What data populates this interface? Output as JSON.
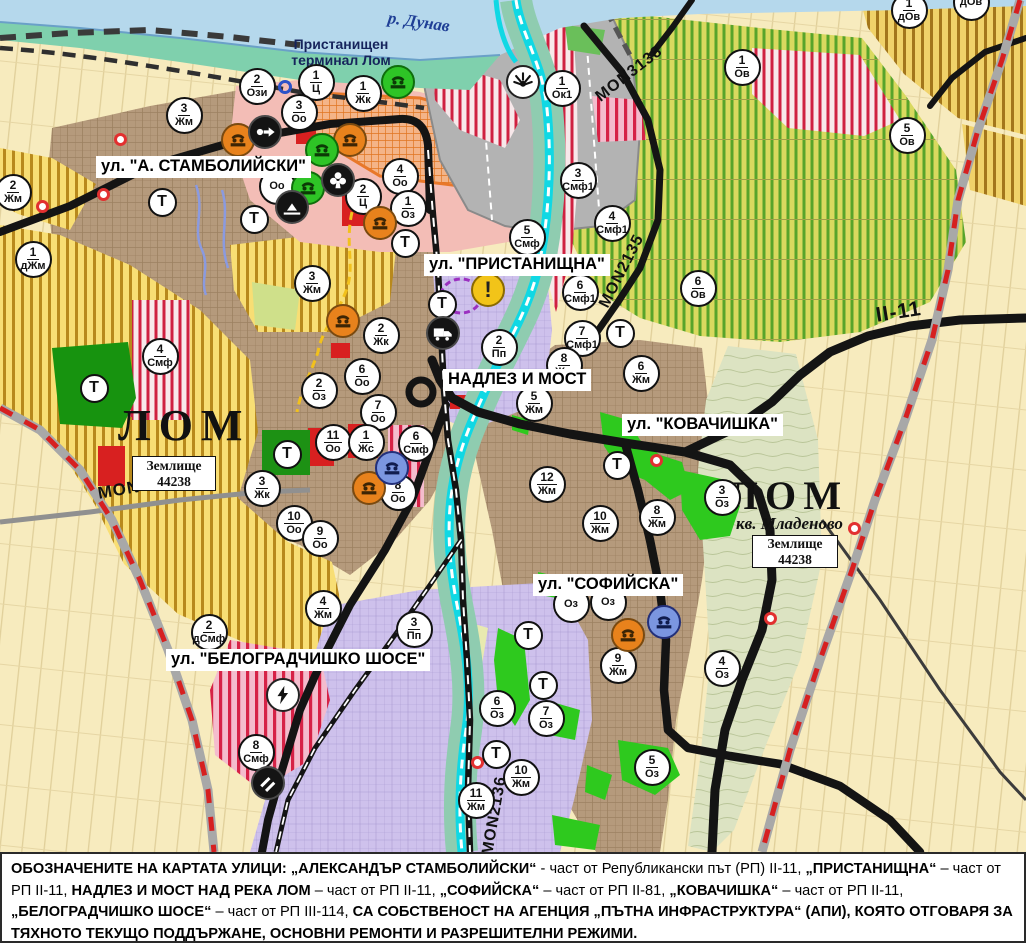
{
  "canvas": {
    "width": 1026,
    "height": 943
  },
  "colors": {
    "danube": "#b5d8ec",
    "coast": "#7fd0ad",
    "river_lom": "#10d8e4",
    "road_black": "#141414",
    "boundary_red": "#d62020",
    "boundary_gray": "#a8a8a8",
    "city_brown": "#b59a7c",
    "residential_yellow": "#f8de74",
    "vineyard_green": "#57a42b",
    "mixed_red_stripe": "#cf2040",
    "industry_purple": "#cec1ec",
    "park_green": "#2ec91e",
    "port_gray": "#b3b3b3",
    "center_pink": "#f3bdb6",
    "warning_yellow": "#f2c419"
  },
  "street_labels": [
    {
      "id": "stamboliyski",
      "text": "ул. \"А. СТАМБОЛИЙСКИ\"",
      "x": 96,
      "y": 156
    },
    {
      "id": "pristanishtna",
      "text": "ул. \"ПРИСТАНИЩНА\"",
      "x": 424,
      "y": 254
    },
    {
      "id": "nadlez",
      "text": "НАДЛЕЗ И МОСТ",
      "x": 443,
      "y": 369
    },
    {
      "id": "kovachishka",
      "text": "ул. \"КОВАЧИШКА\"",
      "x": 622,
      "y": 414
    },
    {
      "id": "sofiyska",
      "text": "ул. \"СОФИЙСКА\"",
      "x": 533,
      "y": 574
    },
    {
      "id": "belogradchishko",
      "text": "ул. \"БЕЛОГРАДЧИШКО ШОСЕ\"",
      "x": 166,
      "y": 649
    }
  ],
  "place_labels": [
    {
      "text": "р. Дунав",
      "cls": "river",
      "x": 388,
      "y": 8,
      "rot": 8,
      "size": 17
    },
    {
      "text": "Пристанищен\nтерминал Лом",
      "cls": "port",
      "x": 266,
      "y": 36,
      "rot": 0,
      "size": 14
    },
    {
      "text": "ЛОМ",
      "cls": "city",
      "x": 118,
      "y": 404,
      "rot": 0,
      "size": 44
    },
    {
      "text": "ЛОМ",
      "cls": "city",
      "x": 728,
      "y": 476,
      "rot": 0,
      "size": 40
    },
    {
      "text": "кв. Младеново",
      "cls": "suburb",
      "x": 736,
      "y": 514,
      "rot": 0,
      "size": 17
    }
  ],
  "road_labels": [
    {
      "text": "MON3138",
      "x": 598,
      "y": 90,
      "rot": -38,
      "size": 16
    },
    {
      "text": "MON2135",
      "x": 604,
      "y": 298,
      "rot": -63,
      "size": 16
    },
    {
      "text": "MON3139",
      "x": 98,
      "y": 484,
      "rot": -10,
      "size": 17
    },
    {
      "text": "MON2136",
      "x": 488,
      "y": 846,
      "rot": -80,
      "size": 16
    },
    {
      "text": "II-11",
      "x": 876,
      "y": 304,
      "rot": -9,
      "size": 21
    }
  ],
  "zemlishte_boxes": [
    {
      "line1": "Землище",
      "line2": "44238",
      "x": 132,
      "y": 456,
      "w": 82,
      "h": 33
    },
    {
      "line1": "Землище",
      "line2": "44238",
      "x": 752,
      "y": 535,
      "w": 84,
      "h": 31
    }
  ],
  "zone_markers": [
    {
      "n": "2",
      "c": "Ози",
      "x": 257,
      "y": 86
    },
    {
      "n": "1",
      "c": "Ц",
      "x": 316,
      "y": 82
    },
    {
      "n": "3",
      "c": "Оо",
      "x": 299,
      "y": 112
    },
    {
      "n": "1",
      "c": "Жк",
      "x": 363,
      "y": 93
    },
    {
      "n": "3",
      "c": "Жм",
      "x": 184,
      "y": 115
    },
    {
      "n": "2",
      "c": "Жм",
      "x": 13,
      "y": 192
    },
    {
      "n": "1",
      "c": "дЖм",
      "x": 33,
      "y": 259
    },
    {
      "n": "4",
      "c": "Оо",
      "x": 400,
      "y": 176
    },
    {
      "n": "2",
      "c": "Ц",
      "x": 363,
      "y": 196
    },
    {
      "n": "1",
      "c": "Оз",
      "x": 408,
      "y": 208
    },
    {
      "n": "",
      "c": "Оо",
      "x": 277,
      "y": 186
    },
    {
      "n": "3",
      "c": "Жм",
      "x": 312,
      "y": 283
    },
    {
      "n": "2",
      "c": "Жк",
      "x": 381,
      "y": 335
    },
    {
      "n": "2",
      "c": "Оз",
      "x": 319,
      "y": 390
    },
    {
      "n": "6",
      "c": "Оо",
      "x": 362,
      "y": 376
    },
    {
      "n": "7",
      "c": "Оо",
      "x": 378,
      "y": 412
    },
    {
      "n": "11",
      "c": "Оо",
      "x": 333,
      "y": 442
    },
    {
      "n": "1",
      "c": "Жс",
      "x": 366,
      "y": 442
    },
    {
      "n": "6",
      "c": "Смф",
      "x": 416,
      "y": 443
    },
    {
      "n": "8",
      "c": "Оо",
      "x": 398,
      "y": 492
    },
    {
      "n": "10",
      "c": "Оо",
      "x": 294,
      "y": 523
    },
    {
      "n": "9",
      "c": "Оо",
      "x": 320,
      "y": 538
    },
    {
      "n": "3",
      "c": "Жк",
      "x": 262,
      "y": 488
    },
    {
      "n": "4",
      "c": "Смф",
      "x": 160,
      "y": 356
    },
    {
      "n": "4",
      "c": "Смф1",
      "x": 612,
      "y": 223
    },
    {
      "n": "3",
      "c": "Смф1",
      "x": 578,
      "y": 180
    },
    {
      "n": "5",
      "c": "Смф",
      "x": 527,
      "y": 237
    },
    {
      "n": "6",
      "c": "Смф1",
      "x": 580,
      "y": 292
    },
    {
      "n": "7",
      "c": "Смф1",
      "x": 582,
      "y": 338
    },
    {
      "n": "2",
      "c": "Пп",
      "x": 499,
      "y": 347
    },
    {
      "n": "8",
      "c": "Жм",
      "x": 564,
      "y": 365
    },
    {
      "n": "5",
      "c": "Жм",
      "x": 534,
      "y": 403
    },
    {
      "n": "1",
      "c": "Ок1",
      "x": 562,
      "y": 88
    },
    {
      "n": "1",
      "c": "Ов",
      "x": 742,
      "y": 67
    },
    {
      "n": "5",
      "c": "Ов",
      "x": 907,
      "y": 135
    },
    {
      "n": "1",
      "c": "дОв",
      "x": 909,
      "y": 10
    },
    {
      "n": "",
      "c": "дОв",
      "x": 971,
      "y": 2
    },
    {
      "n": "6",
      "c": "Ов",
      "x": 698,
      "y": 288
    },
    {
      "n": "6",
      "c": "Жм",
      "x": 641,
      "y": 373
    },
    {
      "n": "12",
      "c": "Жм",
      "x": 547,
      "y": 484
    },
    {
      "n": "10",
      "c": "Жм",
      "x": 600,
      "y": 523
    },
    {
      "n": "8",
      "c": "Жм",
      "x": 657,
      "y": 517
    },
    {
      "n": "3",
      "c": "Оз",
      "x": 722,
      "y": 497
    },
    {
      "n": "2",
      "c": "дСмф",
      "x": 209,
      "y": 632
    },
    {
      "n": "4",
      "c": "Жм",
      "x": 323,
      "y": 608
    },
    {
      "n": "3",
      "c": "Пп",
      "x": 414,
      "y": 629
    },
    {
      "n": "8",
      "c": "Смф",
      "x": 256,
      "y": 752
    },
    {
      "n": "",
      "c": "Оз",
      "x": 571,
      "y": 604
    },
    {
      "n": "",
      "c": "Оз",
      "x": 608,
      "y": 602
    },
    {
      "n": "9",
      "c": "Жм",
      "x": 618,
      "y": 665
    },
    {
      "n": "4",
      "c": "Оз",
      "x": 722,
      "y": 668
    },
    {
      "n": "6",
      "c": "Оз",
      "x": 497,
      "y": 708
    },
    {
      "n": "7",
      "c": "Оз",
      "x": 546,
      "y": 718
    },
    {
      "n": "10",
      "c": "Жм",
      "x": 521,
      "y": 777
    },
    {
      "n": "11",
      "c": "Жм",
      "x": 476,
      "y": 800
    },
    {
      "n": "5",
      "c": "Оз",
      "x": 652,
      "y": 767
    }
  ],
  "transport_markers": {
    "letter": "Т",
    "points": [
      [
        162,
        202
      ],
      [
        254,
        219
      ],
      [
        405,
        243
      ],
      [
        442,
        304
      ],
      [
        620,
        333
      ],
      [
        94,
        388
      ],
      [
        287,
        454
      ],
      [
        617,
        465
      ],
      [
        528,
        635
      ],
      [
        543,
        685
      ],
      [
        496,
        754
      ]
    ]
  },
  "poi_icons": [
    {
      "type": "monument-orange",
      "x": 238,
      "y": 140
    },
    {
      "type": "monument-orange",
      "x": 350,
      "y": 140
    },
    {
      "type": "monument-orange",
      "x": 380,
      "y": 223
    },
    {
      "type": "monument-orange",
      "x": 343,
      "y": 321
    },
    {
      "type": "monument-orange",
      "x": 369,
      "y": 488
    },
    {
      "type": "monument-orange",
      "x": 628,
      "y": 635
    },
    {
      "type": "monument-green",
      "x": 398,
      "y": 82
    },
    {
      "type": "monument-green",
      "x": 322,
      "y": 150
    },
    {
      "type": "monument-green",
      "x": 308,
      "y": 188
    },
    {
      "type": "monument-blue",
      "x": 392,
      "y": 468
    },
    {
      "type": "monument-blue",
      "x": 664,
      "y": 622
    },
    {
      "type": "arrow-black",
      "x": 265,
      "y": 132
    },
    {
      "type": "club-black",
      "x": 338,
      "y": 180
    },
    {
      "type": "mountain-black",
      "x": 292,
      "y": 207
    },
    {
      "type": "fan-white",
      "x": 523,
      "y": 82
    },
    {
      "type": "warning-yellow",
      "x": 488,
      "y": 290
    },
    {
      "type": "truck-black",
      "x": 443,
      "y": 333
    },
    {
      "type": "lightning-white",
      "x": 283,
      "y": 695
    },
    {
      "type": "railcross-black",
      "x": 268,
      "y": 783
    }
  ],
  "red_dots": [
    [
      120,
      139
    ],
    [
      103,
      194
    ],
    [
      42,
      206
    ],
    [
      656,
      460
    ],
    [
      854,
      528
    ],
    [
      770,
      618
    ],
    [
      477,
      762
    ]
  ],
  "blue_rings": [
    [
      285,
      87
    ]
  ],
  "footer": {
    "segments": [
      {
        "bold": true,
        "text": "ОБОЗНАЧЕНИТЕ НА КАРТАТА УЛИЦИ: „АЛЕКСАНДЪР СТАМБОЛИЙСКИ“"
      },
      {
        "bold": false,
        "text": " - част от Републикански път (РП) II-11, "
      },
      {
        "bold": true,
        "text": "„ПРИСТАНИЩНА“"
      },
      {
        "bold": false,
        "text": " – част от РП II-11, "
      },
      {
        "bold": true,
        "text": "НАДЛЕЗ И МОСТ НАД РЕКА ЛОМ"
      },
      {
        "bold": false,
        "text": " – част от РП II-11, "
      },
      {
        "bold": true,
        "text": "„СОФИЙСКА“"
      },
      {
        "bold": false,
        "text": " – част от РП II-81, "
      },
      {
        "bold": true,
        "text": "„КОВАЧИШКА“"
      },
      {
        "bold": false,
        "text": " – част от РП II-11, "
      },
      {
        "bold": true,
        "text": "„БЕЛОГРАДЧИШКО ШОСЕ“"
      },
      {
        "bold": false,
        "text": " – част от РП III-114, "
      },
      {
        "bold": true,
        "text": "СА СОБСТВЕНОСТ НА АГЕНЦИЯ „ПЪТНА ИНФРАСТРУКТУРА“ (АПИ), КОЯТО ОТГОВАРЯ ЗА ТЯХНОТО ТЕКУЩО ПОДДЪРЖАНЕ, ОСНОВНИ РЕМОНТИ И РАЗРЕШИТЕЛНИ РЕЖИМИ."
      }
    ]
  }
}
